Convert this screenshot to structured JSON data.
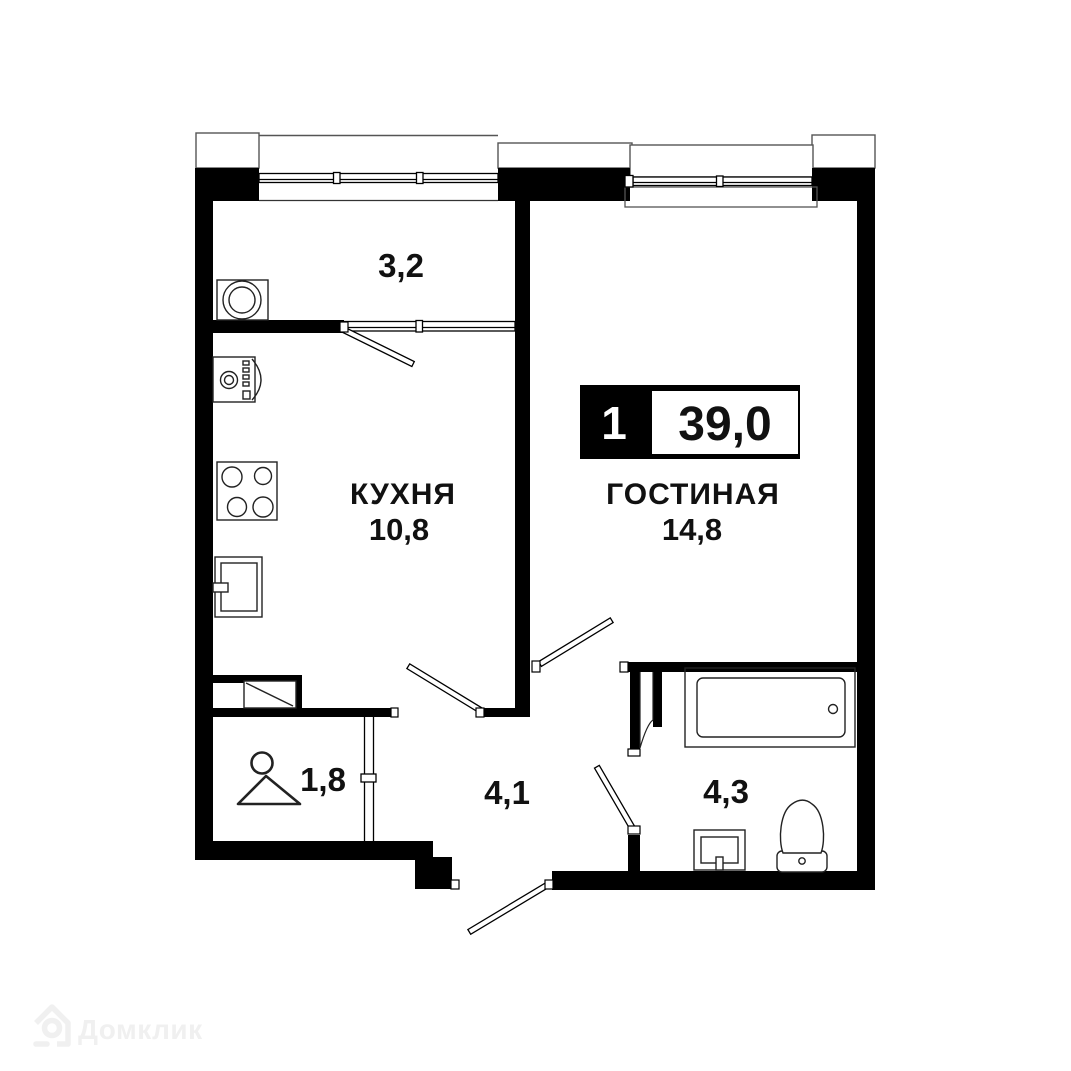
{
  "badge": {
    "rooms_count": "1",
    "total_area": "39,0"
  },
  "rooms": {
    "kitchen": {
      "name": "КУХНЯ",
      "area": "10,8"
    },
    "living": {
      "name": "ГОСТИНАЯ",
      "area": "14,8"
    },
    "balcony": {
      "area": "3,2"
    },
    "wardrobe": {
      "area": "1,8"
    },
    "hallway": {
      "area": "4,1"
    },
    "bathroom": {
      "area": "4,3"
    }
  },
  "fixtures": [
    "washing-machine",
    "oven",
    "stove-4-burners",
    "kitchen-sink",
    "clothes-hanger",
    "vent-shaft",
    "bathtub",
    "bathroom-sink",
    "toilet"
  ],
  "watermark": {
    "brand": "Домклик"
  },
  "colors": {
    "walls": "#000000",
    "background": "#ffffff",
    "watermark": "#f0f0f0"
  }
}
